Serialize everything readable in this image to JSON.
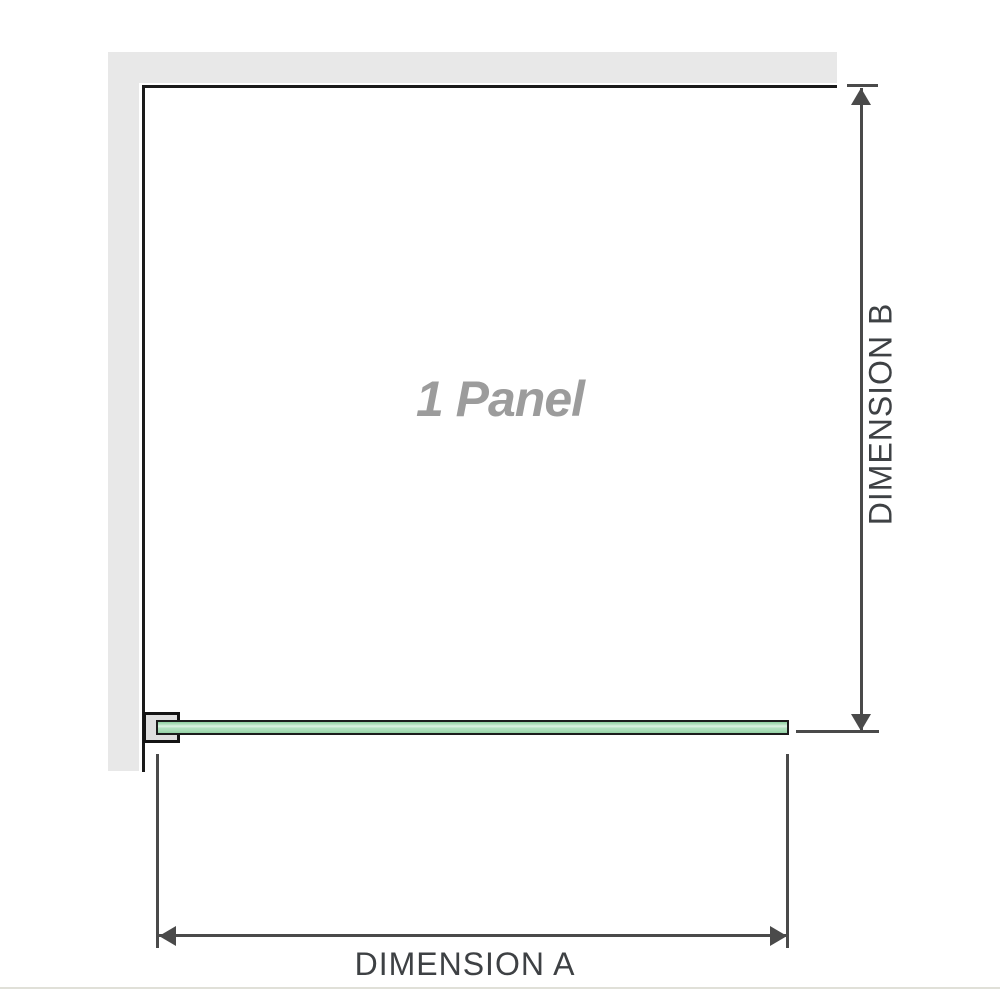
{
  "diagram": {
    "title": "1 panel shower screen dimension diagram",
    "panel_label": "1 Panel",
    "dimension_a_label": "DIMENSION A",
    "dimension_b_label": "DIMENSION B",
    "colors": {
      "wall_gray": "#e8e8e8",
      "frame_black": "#1a1a1a",
      "glass_green": "#a8dcb6",
      "glass_highlight": "#def2e4",
      "bracket_fill": "#dfdfdf",
      "dimension_line": "#4a4a4a",
      "dimension_text": "#3e4144",
      "panel_label_gray": "#9c9c9c",
      "divider": "#e0e0d8"
    }
  }
}
